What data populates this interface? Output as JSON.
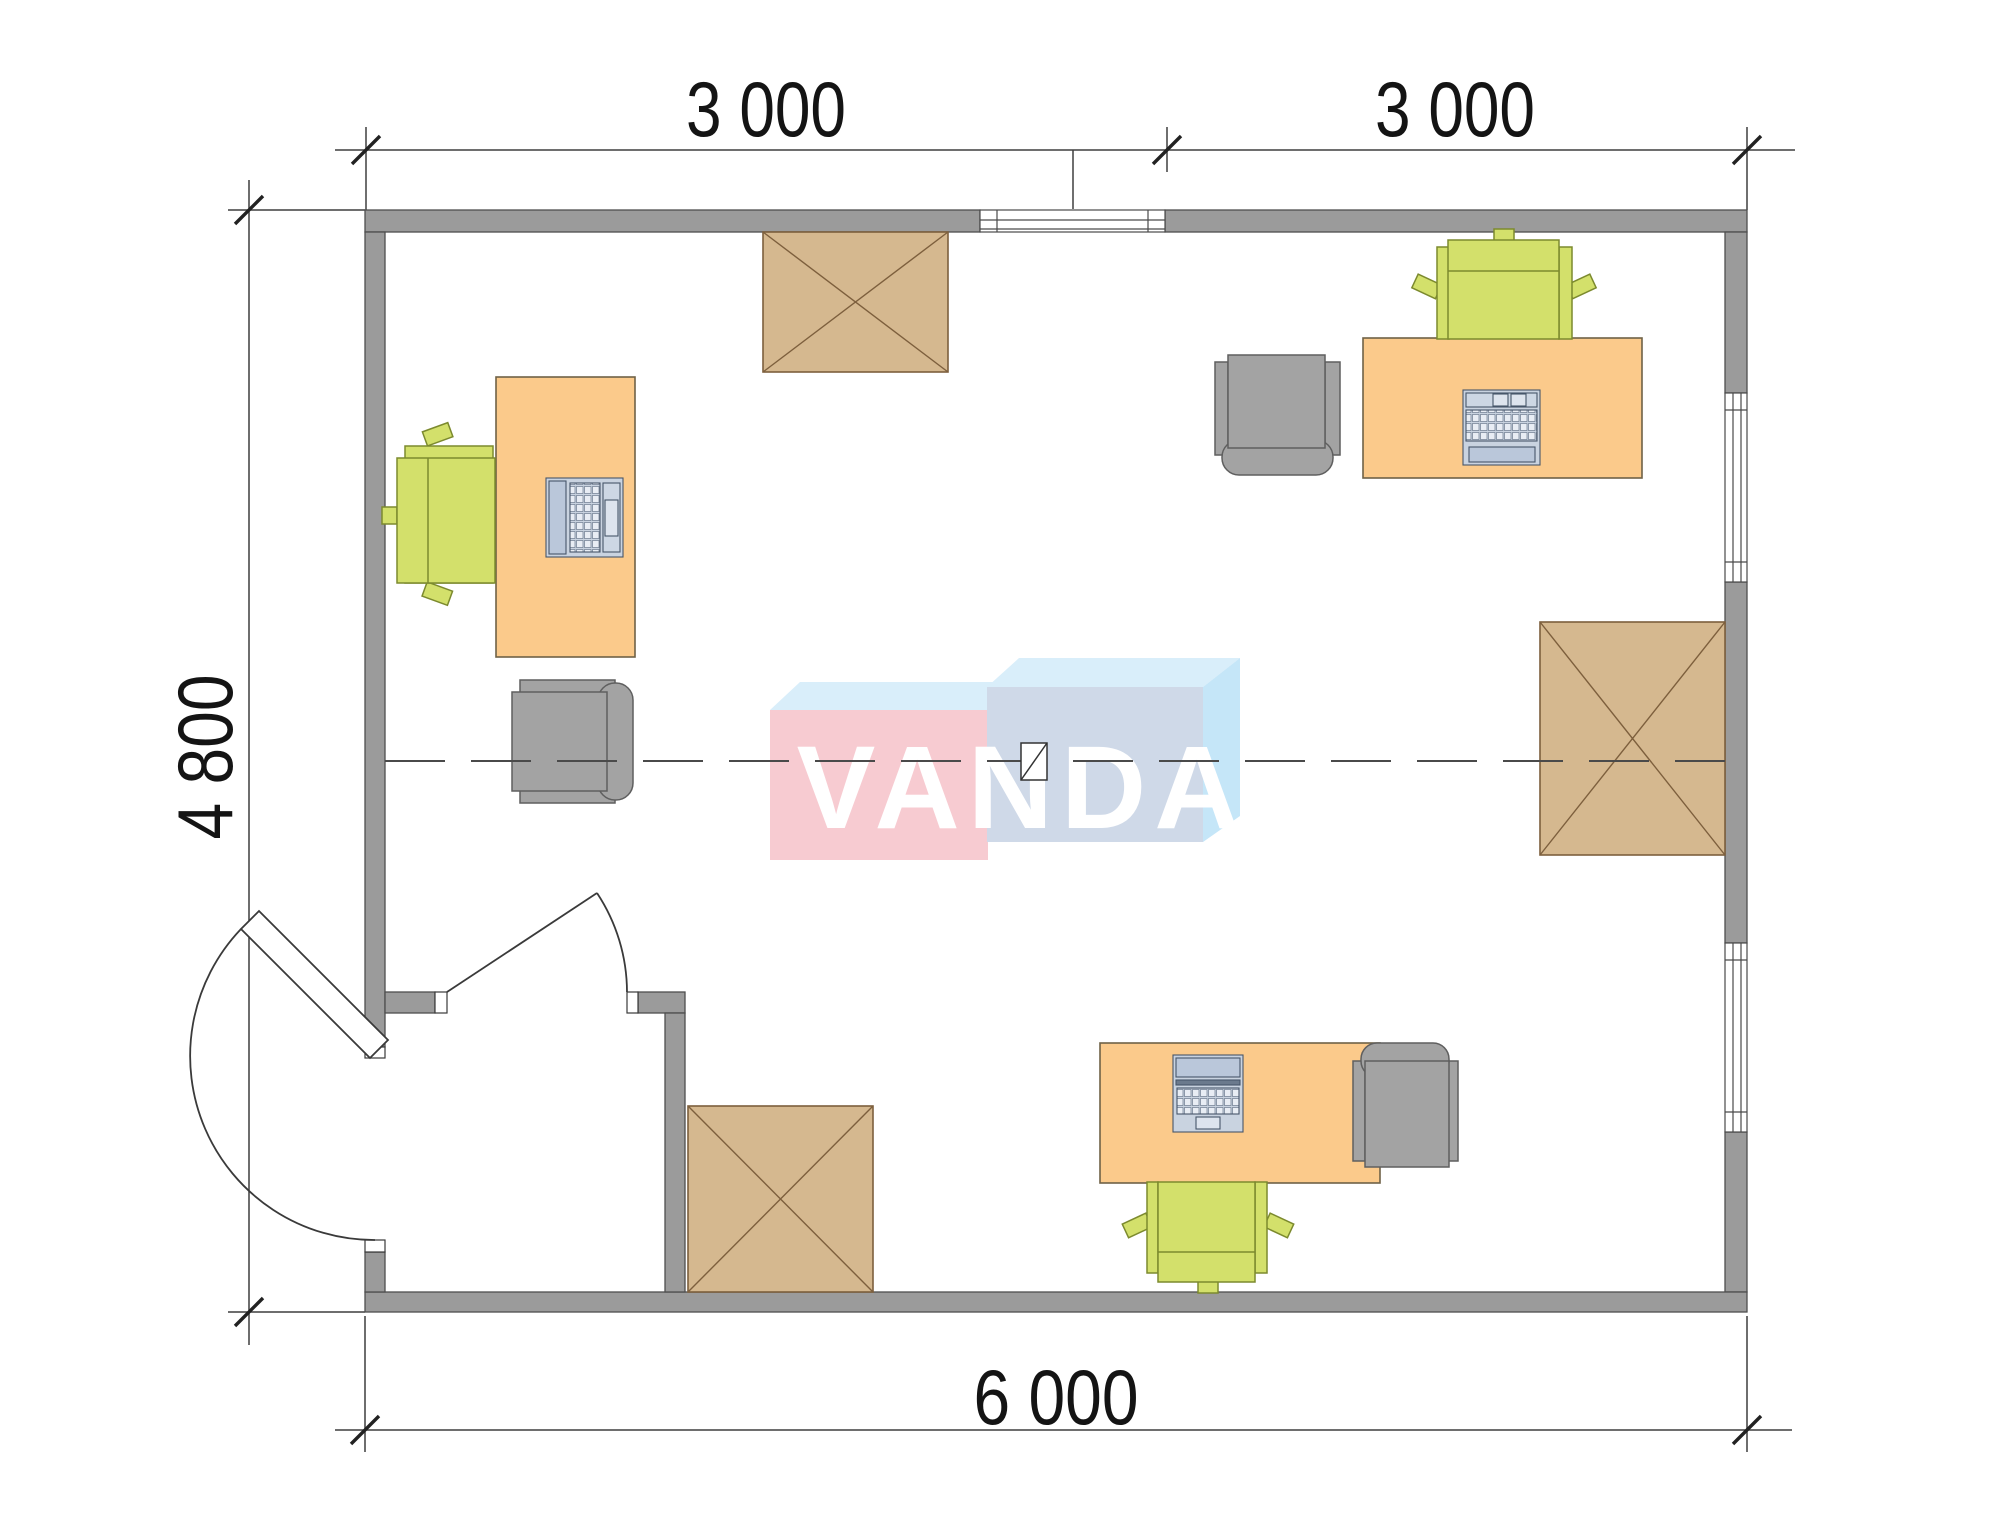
{
  "title": "Office floor plan",
  "dimensions": {
    "top_left": "3 000",
    "top_right": "3 000",
    "left": "4 800",
    "bottom": "6 000"
  },
  "watermark": {
    "text": "VANDA",
    "pink": "#f7cbd1",
    "blue_front": "#cfd9e8",
    "blue_top": "#d9eefa",
    "blue_side": "#c5e6f8"
  },
  "colors": {
    "wall": "#9b9b9b",
    "desk": "#fbca8b",
    "side_table": "#d5b88f",
    "chair_green": "#d3e06b",
    "chair_gray": "#a3a3a3",
    "laptop_body": "#c9d3e0",
    "dimension_line": "#3f3f3f"
  },
  "inventory": {
    "desks": 3,
    "laptops": 3,
    "green_task_chairs": 3,
    "gray_armchairs": 3,
    "crossed_side_tables": 3,
    "windows": 3,
    "doors": 2
  }
}
